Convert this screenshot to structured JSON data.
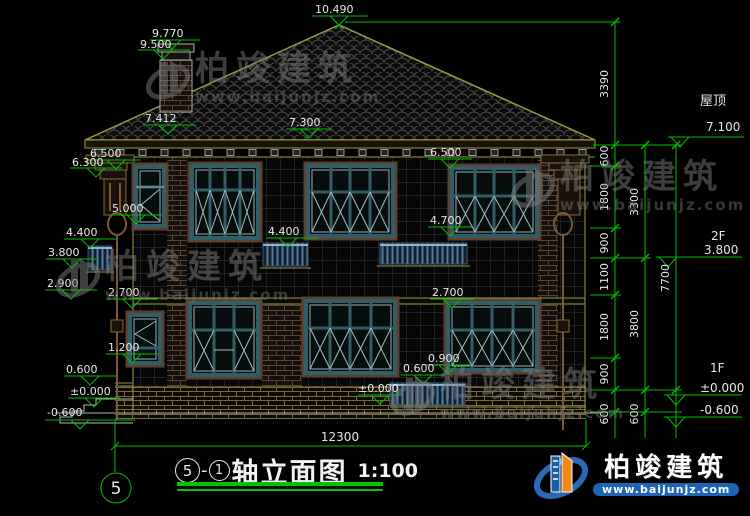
{
  "palette": {
    "dimension_green": "#00bf00",
    "line_yellow": "#9a9a40",
    "window_teal": "#335d66",
    "brand_blue": "#1e63b4",
    "brand_orange": "#f08a1e"
  },
  "brand": {
    "name": "柏竣建筑",
    "url": "www.baijunjz.com"
  },
  "section_title": {
    "axis_start": "5",
    "sep": "-",
    "axis_end": "1",
    "text": "轴立面图",
    "scale": "1:100"
  },
  "axis_bubble": "5",
  "levels": {
    "roof_label": "屋顶",
    "roof": "7.100",
    "f2_label": "2F",
    "f2": "3.800",
    "f1_label": "1F",
    "f1": "±0.000",
    "below": "-0.600"
  },
  "marks": {
    "apex": "10.490",
    "chimney_top": "9.770",
    "chimney_cap": "9.500",
    "chimney_base": "7.412",
    "eave": "7.300",
    "l6500": "6.500",
    "l6300": "6.300",
    "l5000": "5.000",
    "l4400": "4.400",
    "l3800": "3.800",
    "l2900": "2.900",
    "l2700": "2.700",
    "l1200": "1.200",
    "l0600": "0.600",
    "l0000": "±0.000",
    "lm0600": "-0.600",
    "m4400": "4.400",
    "m4700": "4.700",
    "m6500": "6.500",
    "m2700": "2.700",
    "m0900": "0.900",
    "m0600": "0.600",
    "m0000": "±0.000"
  },
  "chains": {
    "c1": [
      "3390",
      "600",
      "1800",
      "900",
      "1100",
      "1800",
      "900",
      "600"
    ],
    "c2": [
      "3300",
      "3800",
      "600"
    ],
    "c3": [
      "7700"
    ],
    "total_width": "12300"
  }
}
